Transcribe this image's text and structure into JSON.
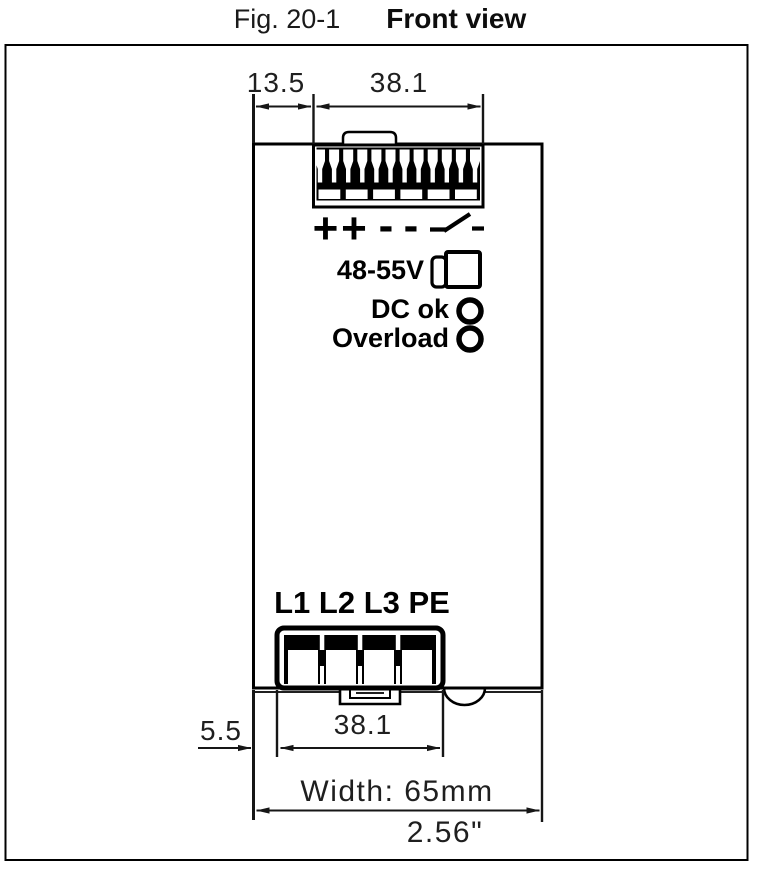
{
  "title": {
    "prefix": "Fig. 20-1",
    "main": "Front view"
  },
  "dimensions": {
    "top_offset": "13.5",
    "top_width": "38.1",
    "bottom_offset": "5.5",
    "bottom_width": "38.1",
    "overall_width_metric": "Width: 65mm",
    "overall_width_inches": "2.56\""
  },
  "device": {
    "output_voltage_label": "48-55V",
    "dc_ok_label": "DC ok",
    "overload_label": "Overload",
    "input_terminal_labels": "L1 L2 L3 PE",
    "output_terminal_symbols": [
      "+",
      "+",
      "-",
      "-"
    ]
  },
  "colors": {
    "line": "#000000",
    "dim_text": "#1f1f1f",
    "background": "#ffffff"
  }
}
